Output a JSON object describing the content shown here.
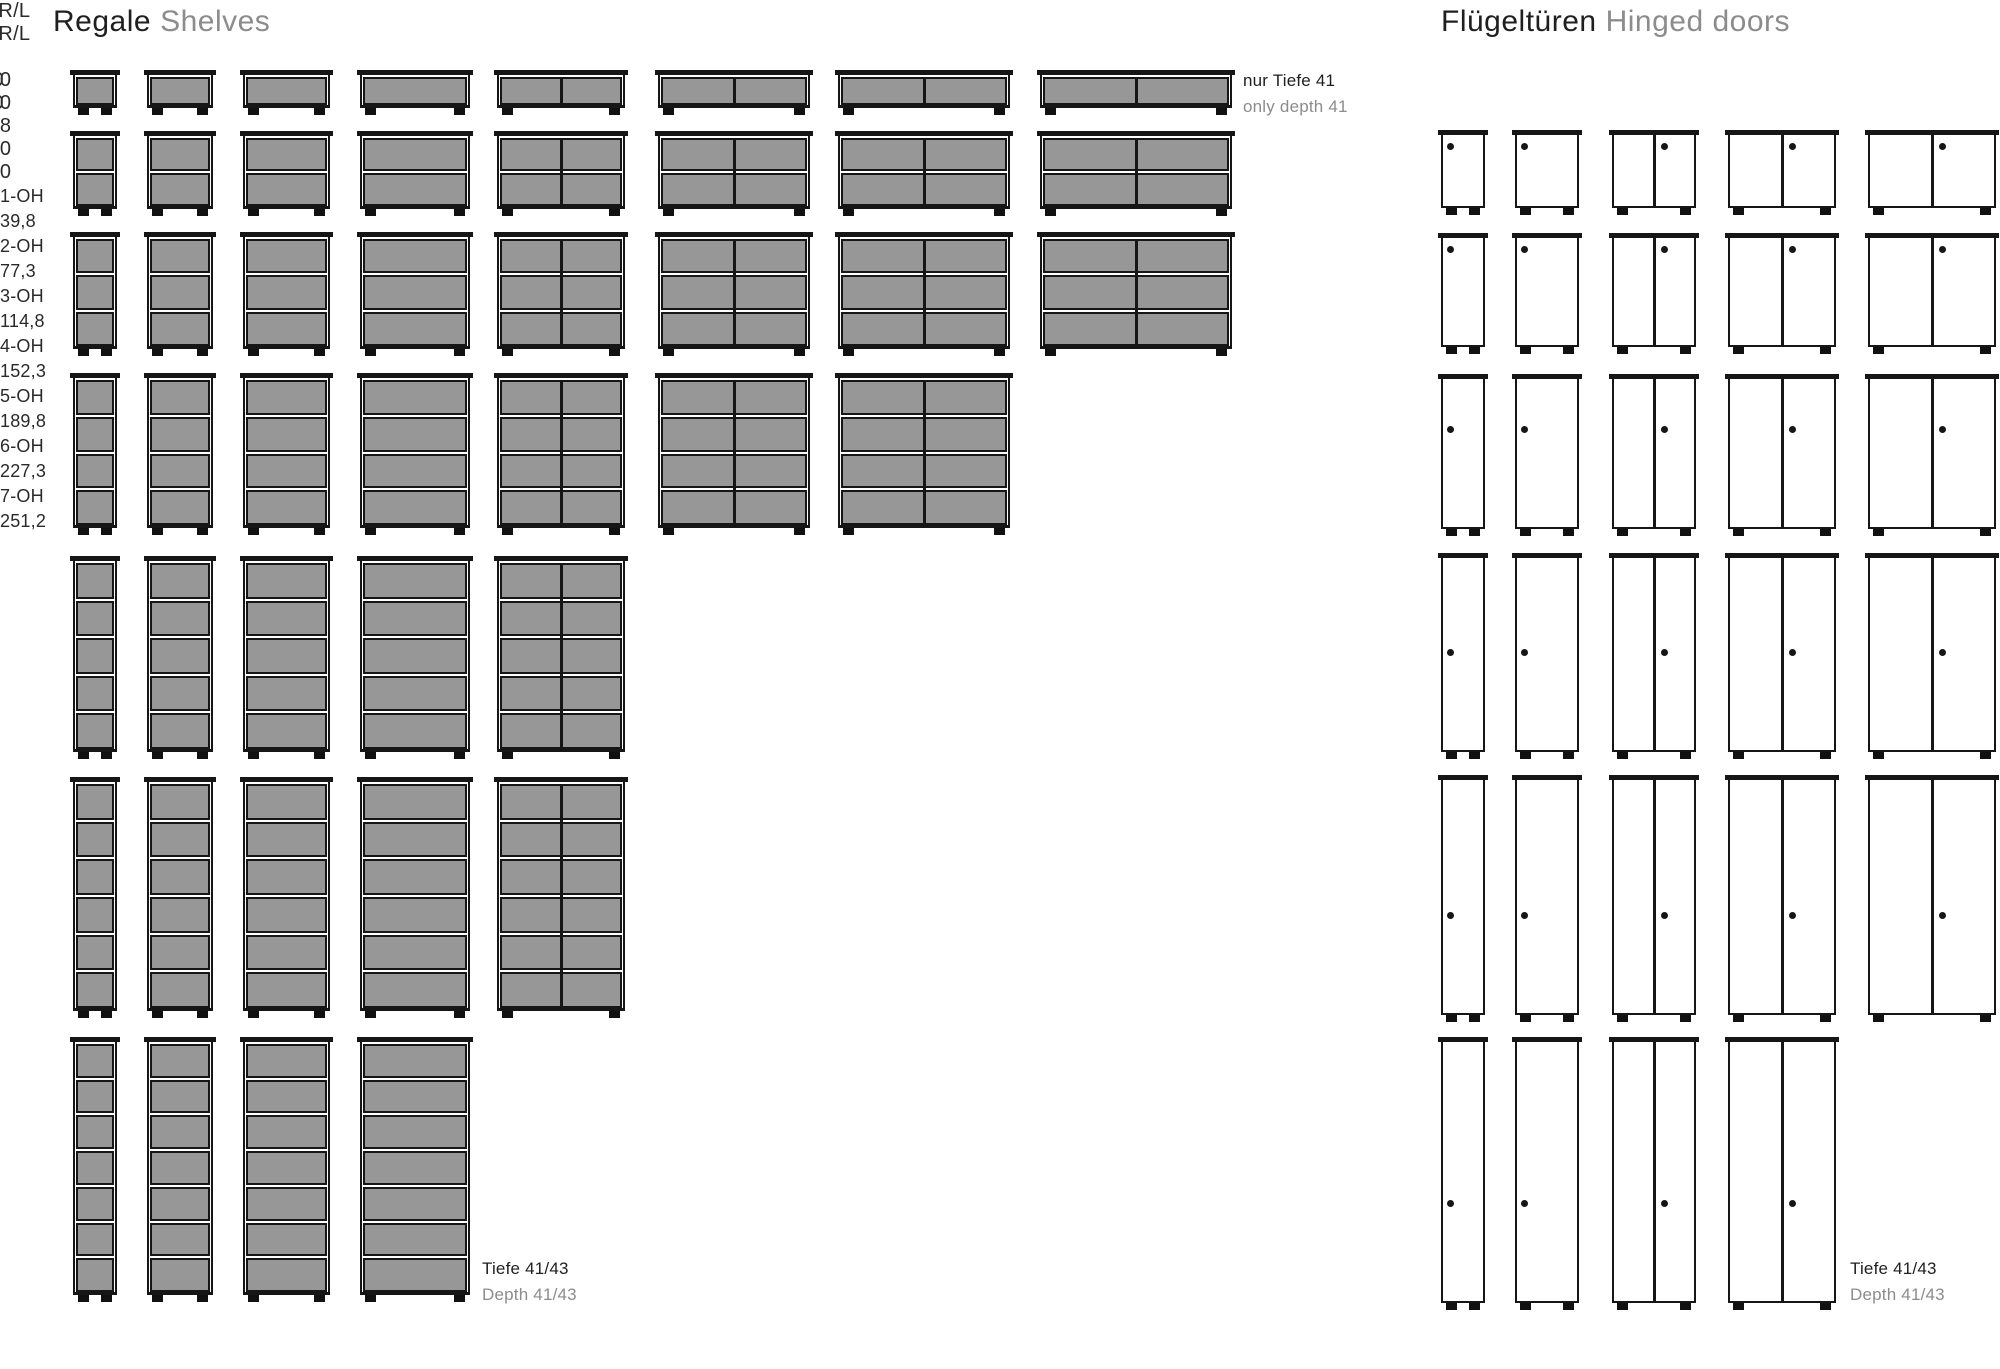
{
  "colors": {
    "line": "#161616",
    "shelf_fill": "#979797",
    "text": "#1f1f1f",
    "text_muted": "#8c8c8c"
  },
  "shelves_section": {
    "title_de": "Regale",
    "title_en": "Shelves",
    "column_headers": [
      {
        "key": "40",
        "label": "40"
      },
      {
        "key": "60",
        "label": "60"
      },
      {
        "key": "80",
        "label": "80"
      },
      {
        "key": "100",
        "label": "100"
      },
      {
        "key": "120",
        "label": "120"
      },
      {
        "key": "138",
        "label": "138"
      },
      {
        "key": "160",
        "label": "160"
      },
      {
        "key": "180",
        "label": "180"
      }
    ],
    "rows": [
      {
        "oh": 1,
        "label": "1-OH",
        "height_cm": "39,8",
        "widths": [
          "40",
          "60",
          "80",
          "100",
          "120",
          "138",
          "160",
          "180"
        ]
      },
      {
        "oh": 2,
        "label": "2-OH",
        "height_cm": "77,3",
        "widths": [
          "40",
          "60",
          "80",
          "100",
          "120",
          "138",
          "160",
          "180"
        ]
      },
      {
        "oh": 3,
        "label": "3-OH",
        "height_cm": "114,8",
        "widths": [
          "40",
          "60",
          "80",
          "100",
          "120",
          "138",
          "160",
          "180"
        ]
      },
      {
        "oh": 4,
        "label": "4-OH",
        "height_cm": "152,3",
        "widths": [
          "40",
          "60",
          "80",
          "100",
          "120",
          "138",
          "160"
        ]
      },
      {
        "oh": 5,
        "label": "5-OH",
        "height_cm": "189,8",
        "widths": [
          "40",
          "60",
          "80",
          "100",
          "120"
        ]
      },
      {
        "oh": 6,
        "label": "6-OH",
        "height_cm": "227,3",
        "widths": [
          "40",
          "60",
          "80",
          "100",
          "120"
        ]
      },
      {
        "oh": 7,
        "label": "7-OH",
        "height_cm": "251,2",
        "widths": [
          "40",
          "60",
          "80",
          "100"
        ]
      }
    ],
    "row1_note_de": "nur Tiefe 41",
    "row1_note_en": "only depth 41",
    "depth_note_de": "Tiefe 41/43",
    "depth_note_en": "Depth 41/43"
  },
  "doors_section": {
    "title_de": "Flügeltüren",
    "title_en": "Hinged doors",
    "column_headers": [
      {
        "key": "40",
        "label": "40 R/L"
      },
      {
        "key": "60",
        "label": "60 R/L"
      },
      {
        "key": "80",
        "label": "80"
      },
      {
        "key": "100",
        "label": "100"
      },
      {
        "key": "120",
        "label": "120"
      }
    ],
    "rows": [
      {
        "oh": 2,
        "widths": [
          "40",
          "60",
          "80",
          "100",
          "120"
        ]
      },
      {
        "oh": 3,
        "widths": [
          "40",
          "60",
          "80",
          "100",
          "120"
        ]
      },
      {
        "oh": 4,
        "widths": [
          "40",
          "60",
          "80",
          "100",
          "120"
        ]
      },
      {
        "oh": 5,
        "widths": [
          "40",
          "60",
          "80",
          "100",
          "120"
        ]
      },
      {
        "oh": 6,
        "widths": [
          "40",
          "60",
          "80",
          "100",
          "120"
        ]
      },
      {
        "oh": 7,
        "widths": [
          "40",
          "60",
          "80",
          "100"
        ]
      }
    ],
    "depth_note_de": "Tiefe 41/43",
    "depth_note_en": "Depth 41/43"
  }
}
